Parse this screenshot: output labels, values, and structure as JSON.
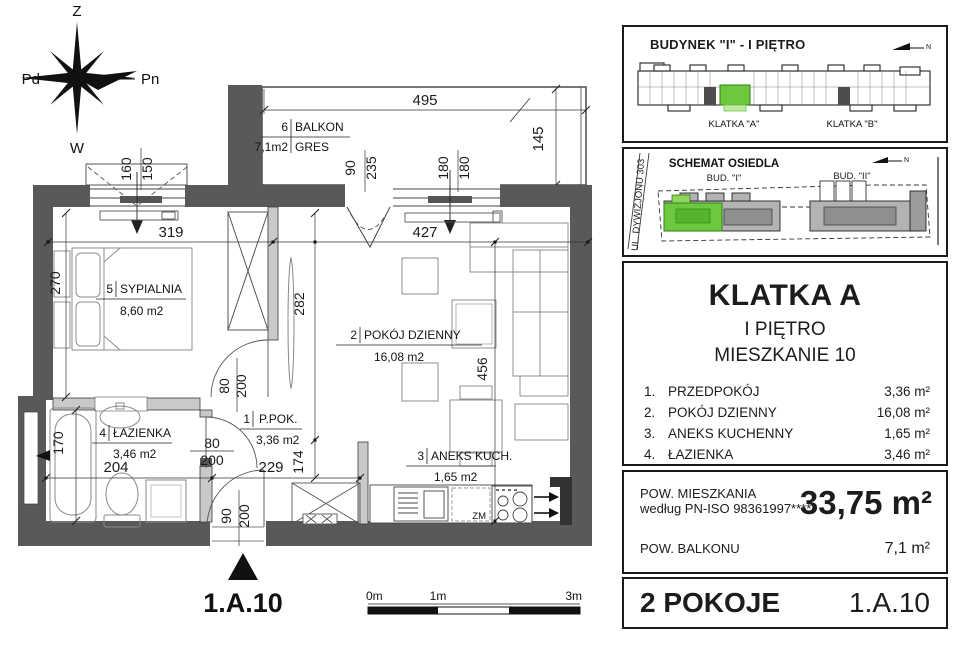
{
  "compass": {
    "top": "Z",
    "right": "Pn",
    "bottom": "W",
    "left": "Pd"
  },
  "plan": {
    "rooms": {
      "balkon": {
        "num": "6",
        "name": "BALKON",
        "area": "7,1m2",
        "floor": "GRES"
      },
      "sypialnia": {
        "num": "5",
        "name": "SYPIALNIA",
        "area": "8,60 m2"
      },
      "dzienny": {
        "num": "2",
        "name": "POKÓJ DZIENNY",
        "area": "16,08 m2"
      },
      "ppok": {
        "num": "1",
        "name": "P.POK.",
        "area": "3,36 m2"
      },
      "lazienka": {
        "num": "4",
        "name": "ŁAZIENKA",
        "area": "3,46 m2"
      },
      "aneks": {
        "num": "3",
        "name": "ANEKS KUCH.",
        "area": "1,65 m2"
      }
    },
    "dims": {
      "d495": "495",
      "d145": "145",
      "d160": "160",
      "d150": "150",
      "d90a": "90",
      "d235": "235",
      "d180a": "180",
      "d180b": "180",
      "d319": "319",
      "d427": "427",
      "d270": "270",
      "d282": "282",
      "d456": "456",
      "d80a": "80",
      "d200a": "200",
      "d80b": "80",
      "d200b": "200",
      "d90b": "90",
      "d200c": "200",
      "d229": "229",
      "d174": "174",
      "d204": "204",
      "d170": "170"
    },
    "labels": {
      "apartment": "1.A.10",
      "zm": "ZM"
    },
    "scale": {
      "m0": "0m",
      "m1": "1m",
      "m3": "3m"
    }
  },
  "panel": {
    "building": {
      "title": "BUDYNEK \"I\" - I PIĘTRO",
      "klatka_a": "KLATKA \"A\"",
      "klatka_b": "KLATKA \"B\"",
      "north": "N"
    },
    "estate": {
      "title": "SCHEMAT OSIEDLA",
      "street": "UL. DYWIZJONU 303",
      "bud1": "BUD. \"I\"",
      "bud2": "BUD. \"II\"",
      "north": "N"
    },
    "unit": {
      "title": "KLATKA A",
      "floor": "I PIĘTRO",
      "apartment": "MIESZKANIE 10",
      "rooms": [
        {
          "no": "1.",
          "name": "PRZEDPOKÓJ",
          "area": "3,36 m²"
        },
        {
          "no": "2.",
          "name": "POKÓJ DZIENNY",
          "area": "16,08 m²"
        },
        {
          "no": "3.",
          "name": "ANEKS KUCHENNY",
          "area": "1,65 m²"
        },
        {
          "no": "4.",
          "name": "ŁAZIENKA",
          "area": "3,46 m²"
        },
        {
          "no": "5.",
          "name": "SYPIALNIA",
          "area": "8,60m²"
        }
      ]
    },
    "areas": {
      "apt_label": "POW. MIESZKANIA",
      "apt_norm": "według PN-ISO 98361997*****",
      "apt_value": "33,75 m²",
      "balcony_label": "POW. BALKONU",
      "balcony_value": "7,1 m²"
    },
    "footer": {
      "rooms": "2 POKOJE",
      "unit": "1.A.10"
    }
  },
  "colors": {
    "highlight_green": "#6cc83e",
    "wall_gray": "#595959"
  }
}
